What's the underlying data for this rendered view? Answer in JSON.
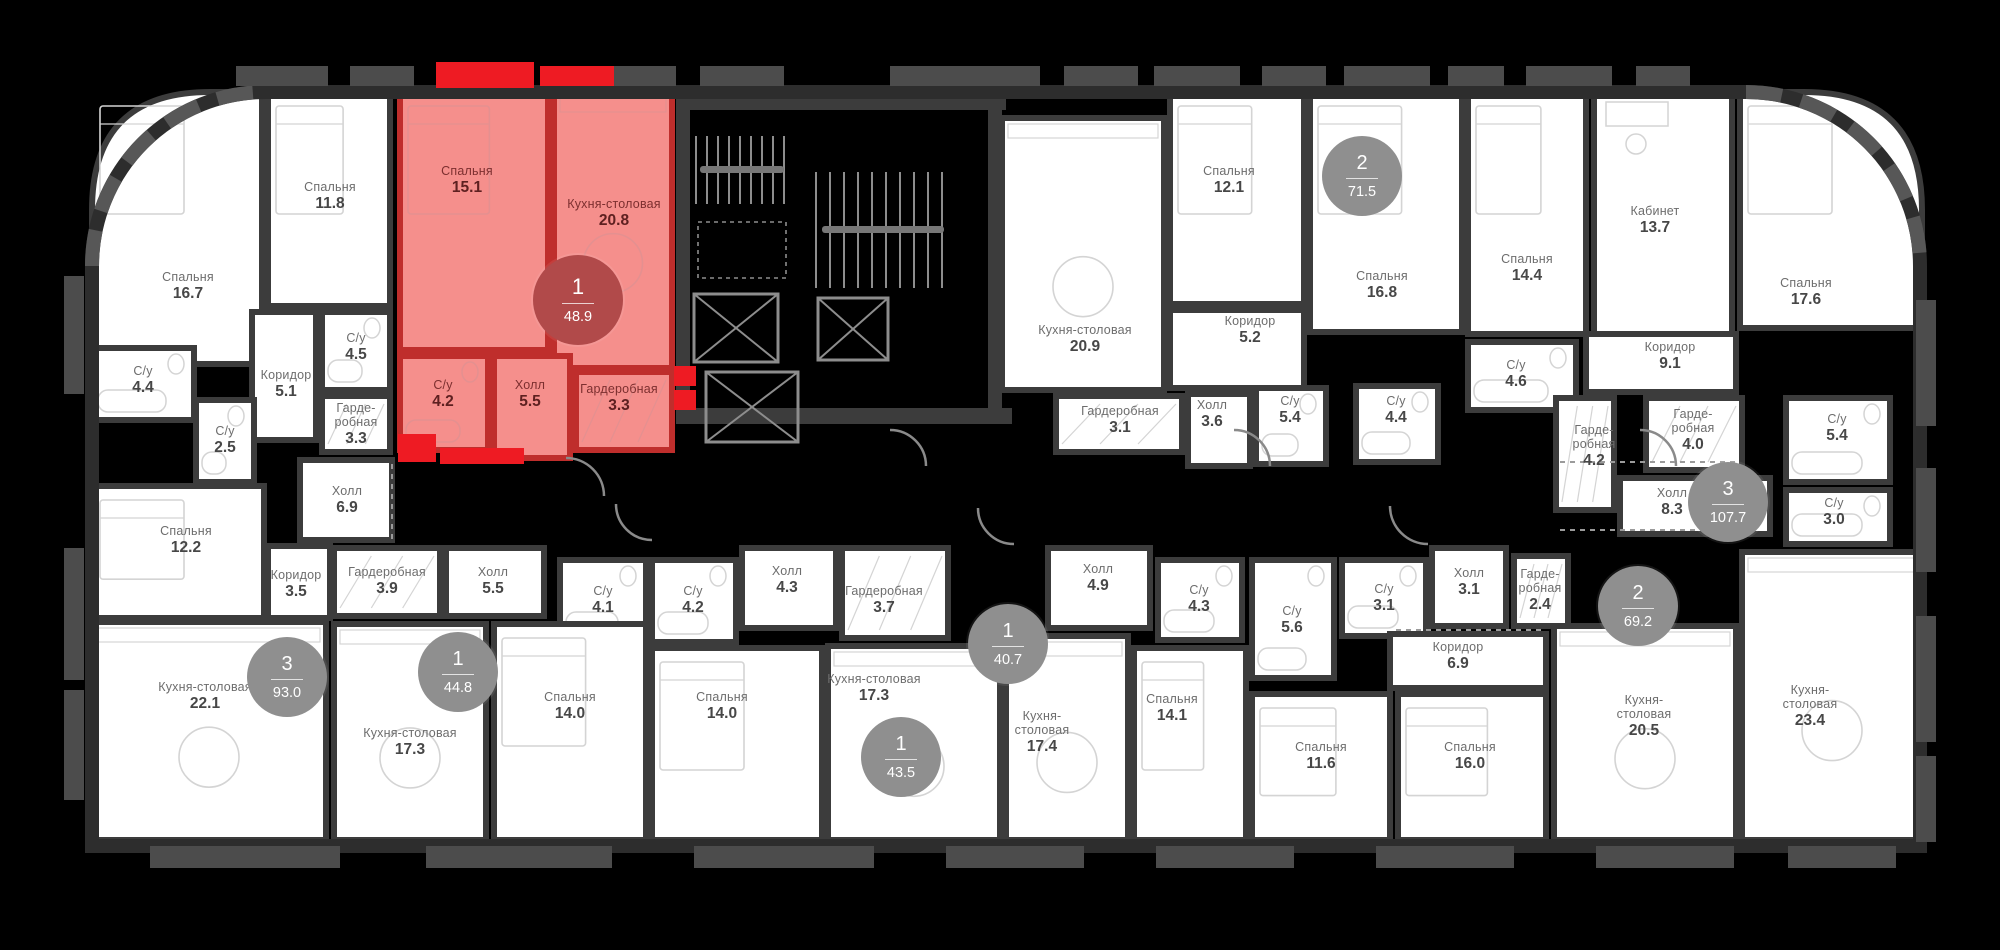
{
  "colors": {
    "background": "#000000",
    "room_fill": "#ffffff",
    "wall": "#3c3c3c",
    "outer_wall": "#2d2d2d",
    "outer_trim": "#575757",
    "tab": "#4c4c4c",
    "core": "#8d8d8d",
    "door_arc": "#8a8a8a",
    "dashed_line": "#9b9b9b",
    "highlight_fill": "#f58f8c",
    "highlight_wall": "#bf2e2c",
    "highlight_accent": "#ee1b23",
    "badge": "#8f8f8f",
    "badge_highlight": "#b14a4a",
    "furniture": "#d4d4d4",
    "furniture_highlight": "#e49090"
  },
  "apartments": [
    {
      "id": "apt-93-0",
      "rooms_count": "3",
      "area": "93.0",
      "highlighted": false,
      "badge": {
        "x": 287,
        "y": 677
      },
      "rooms": [
        {
          "name": "Спальня",
          "area": "16.7",
          "x": 92,
          "y": 92,
          "w": 170,
          "h": 272,
          "corner": "tl",
          "lx": 188,
          "ly": 286
        },
        {
          "name": "Спальня",
          "area": "11.8",
          "x": 268,
          "y": 92,
          "w": 122,
          "h": 214,
          "lx": 330,
          "ly": 196
        },
        {
          "name": "С/у",
          "area": "4.4",
          "x": 92,
          "y": 348,
          "w": 102,
          "h": 72,
          "lx": 143,
          "ly": 380
        },
        {
          "name": "С/у",
          "area": "4.5",
          "x": 322,
          "y": 312,
          "w": 68,
          "h": 78,
          "lx": 356,
          "ly": 347
        },
        {
          "name": "Коридор",
          "area": "5.1",
          "x": 252,
          "y": 312,
          "w": 64,
          "h": 128,
          "lx": 286,
          "ly": 384
        },
        {
          "name": "С/у",
          "area": "2.5",
          "x": 196,
          "y": 400,
          "w": 58,
          "h": 82,
          "lx": 225,
          "ly": 440
        },
        {
          "name": "Гарде-\nробная",
          "area": "3.3",
          "x": 322,
          "y": 396,
          "w": 68,
          "h": 56,
          "lx": 356,
          "ly": 424
        },
        {
          "name": "Холл",
          "area": "6.9",
          "x": 300,
          "y": 460,
          "w": 92,
          "h": 80,
          "lx": 347,
          "ly": 500
        },
        {
          "name": "Спальня",
          "area": "12.2",
          "x": 92,
          "y": 486,
          "w": 172,
          "h": 132,
          "lx": 186,
          "ly": 540
        },
        {
          "name": "Коридор",
          "area": "3.5",
          "x": 268,
          "y": 546,
          "w": 62,
          "h": 72,
          "lx": 296,
          "ly": 584
        },
        {
          "name": "Кухня-столовая",
          "area": "22.1",
          "x": 92,
          "y": 622,
          "w": 234,
          "h": 218,
          "lx": 205,
          "ly": 696
        }
      ]
    },
    {
      "id": "apt-48-9",
      "rooms_count": "1",
      "area": "48.9",
      "highlighted": true,
      "badge": {
        "x": 578,
        "y": 300
      },
      "rooms": [
        {
          "name": "Спальня",
          "area": "15.1",
          "x": 400,
          "y": 92,
          "w": 148,
          "h": 258,
          "lx": 467,
          "ly": 180
        },
        {
          "name": "Кухня-столовая",
          "area": "20.8",
          "x": 554,
          "y": 92,
          "w": 118,
          "h": 276,
          "lx": 614,
          "ly": 213
        },
        {
          "name": "С/у",
          "area": "4.2",
          "x": 400,
          "y": 356,
          "w": 88,
          "h": 94,
          "lx": 443,
          "ly": 394
        },
        {
          "name": "Холл",
          "area": "5.5",
          "x": 494,
          "y": 356,
          "w": 76,
          "h": 102,
          "lx": 530,
          "ly": 394
        },
        {
          "name": "Гардеробная",
          "area": "3.3",
          "x": 576,
          "y": 372,
          "w": 96,
          "h": 78,
          "lx": 619,
          "ly": 398
        }
      ]
    },
    {
      "id": "apt-44-8",
      "rooms_count": "1",
      "area": "44.8",
      "highlighted": false,
      "badge": {
        "x": 458,
        "y": 672
      },
      "rooms": [
        {
          "name": "Гардеробная",
          "area": "3.9",
          "x": 334,
          "y": 548,
          "w": 106,
          "h": 68,
          "lx": 387,
          "ly": 581
        },
        {
          "name": "Холл",
          "area": "5.5",
          "x": 446,
          "y": 548,
          "w": 98,
          "h": 68,
          "lx": 493,
          "ly": 581
        },
        {
          "name": "С/у",
          "area": "4.1",
          "x": 560,
          "y": 560,
          "w": 86,
          "h": 82,
          "lx": 603,
          "ly": 600
        },
        {
          "name": "Кухня-столовая",
          "area": "17.3",
          "x": 334,
          "y": 624,
          "w": 152,
          "h": 216,
          "lx": 410,
          "ly": 742
        },
        {
          "name": "Спальня",
          "area": "14.0",
          "x": 494,
          "y": 624,
          "w": 152,
          "h": 216,
          "lx": 570,
          "ly": 706
        }
      ]
    },
    {
      "id": "apt-43-5",
      "rooms_count": "1",
      "area": "43.5",
      "highlighted": false,
      "badge": {
        "x": 901,
        "y": 757
      },
      "rooms": [
        {
          "name": "С/у",
          "area": "4.2",
          "x": 652,
          "y": 560,
          "w": 84,
          "h": 82,
          "lx": 693,
          "ly": 600
        },
        {
          "name": "Холл",
          "area": "4.3",
          "x": 742,
          "y": 548,
          "w": 94,
          "h": 80,
          "lx": 787,
          "ly": 580
        },
        {
          "name": "Гардеробная",
          "area": "3.7",
          "x": 842,
          "y": 548,
          "w": 106,
          "h": 90,
          "lx": 884,
          "ly": 600
        },
        {
          "name": "Спальня",
          "area": "14.0",
          "x": 652,
          "y": 648,
          "w": 170,
          "h": 192,
          "lx": 722,
          "ly": 706
        },
        {
          "name": "Кухня-столовая",
          "area": "17.3",
          "x": 828,
          "y": 646,
          "w": 172,
          "h": 194,
          "lx": 874,
          "ly": 688
        }
      ]
    },
    {
      "id": "apt-40-7",
      "rooms_count": "1",
      "area": "40.7",
      "highlighted": false,
      "badge": {
        "x": 1008,
        "y": 644
      },
      "rooms": [
        {
          "name": "Холл",
          "area": "4.9",
          "x": 1048,
          "y": 548,
          "w": 102,
          "h": 80,
          "lx": 1098,
          "ly": 578
        },
        {
          "name": "С/у",
          "area": "4.3",
          "x": 1158,
          "y": 560,
          "w": 84,
          "h": 80,
          "lx": 1199,
          "ly": 599
        },
        {
          "name": "Кухня-\nстоловая",
          "area": "17.4",
          "x": 1006,
          "y": 636,
          "w": 122,
          "h": 204,
          "lx": 1042,
          "ly": 732
        },
        {
          "name": "Спальня",
          "area": "14.1",
          "x": 1134,
          "y": 648,
          "w": 112,
          "h": 192,
          "lx": 1172,
          "ly": 708
        }
      ]
    },
    {
      "id": "apt-71-5",
      "rooms_count": "2",
      "area": "71.5",
      "highlighted": false,
      "badge": {
        "x": 1362,
        "y": 176
      },
      "rooms": [
        {
          "name": "Кухня-столовая",
          "area": "20.9",
          "x": 1002,
          "y": 118,
          "w": 162,
          "h": 272,
          "lx": 1085,
          "ly": 339
        },
        {
          "name": "Спальня",
          "area": "12.1",
          "x": 1170,
          "y": 92,
          "w": 134,
          "h": 212,
          "lx": 1229,
          "ly": 180
        },
        {
          "name": "Спальня",
          "area": "16.8",
          "x": 1310,
          "y": 92,
          "w": 152,
          "h": 240,
          "lx": 1382,
          "ly": 285
        },
        {
          "name": "Коридор",
          "area": "5.2",
          "x": 1170,
          "y": 310,
          "w": 134,
          "h": 78,
          "lx": 1250,
          "ly": 330
        },
        {
          "name": "Гардеробная",
          "area": "3.1",
          "x": 1056,
          "y": 396,
          "w": 126,
          "h": 56,
          "lx": 1120,
          "ly": 420
        },
        {
          "name": "Холл",
          "area": "3.6",
          "x": 1188,
          "y": 394,
          "w": 62,
          "h": 72,
          "lx": 1212,
          "ly": 414
        },
        {
          "name": "С/у",
          "area": "5.4",
          "x": 1256,
          "y": 388,
          "w": 70,
          "h": 76,
          "lx": 1290,
          "ly": 410
        },
        {
          "name": "С/у",
          "area": "4.4",
          "x": 1356,
          "y": 386,
          "w": 82,
          "h": 76,
          "lx": 1396,
          "ly": 410
        }
      ]
    },
    {
      "id": "apt-69-2",
      "rooms_count": "2",
      "area": "69.2",
      "highlighted": false,
      "badge": {
        "x": 1638,
        "y": 606
      },
      "rooms": [
        {
          "name": "С/у",
          "area": "5.6",
          "x": 1252,
          "y": 560,
          "w": 82,
          "h": 118,
          "lx": 1292,
          "ly": 620
        },
        {
          "name": "С/у",
          "area": "3.1",
          "x": 1342,
          "y": 560,
          "w": 84,
          "h": 76,
          "lx": 1384,
          "ly": 598
        },
        {
          "name": "Холл",
          "area": "3.1",
          "x": 1432,
          "y": 548,
          "w": 74,
          "h": 78,
          "lx": 1469,
          "ly": 582
        },
        {
          "name": "Гарде-\nробная",
          "area": "2.4",
          "x": 1514,
          "y": 556,
          "w": 54,
          "h": 70,
          "lx": 1540,
          "ly": 590
        },
        {
          "name": "Коридор",
          "area": "6.9",
          "x": 1390,
          "y": 634,
          "w": 156,
          "h": 54,
          "lx": 1458,
          "ly": 656
        },
        {
          "name": "Спальня",
          "area": "11.6",
          "x": 1252,
          "y": 694,
          "w": 138,
          "h": 146,
          "lx": 1321,
          "ly": 756
        },
        {
          "name": "Спальня",
          "area": "16.0",
          "x": 1398,
          "y": 694,
          "w": 148,
          "h": 146,
          "lx": 1470,
          "ly": 756
        },
        {
          "name": "Кухня-\nстоловая",
          "area": "20.5",
          "x": 1554,
          "y": 626,
          "w": 182,
          "h": 214,
          "lx": 1644,
          "ly": 716
        }
      ]
    },
    {
      "id": "apt-107-7",
      "rooms_count": "3",
      "area": "107.7",
      "highlighted": false,
      "badge": {
        "x": 1728,
        "y": 502
      },
      "rooms": [
        {
          "name": "Спальня",
          "area": "14.4",
          "x": 1468,
          "y": 92,
          "w": 118,
          "h": 242,
          "lx": 1527,
          "ly": 268
        },
        {
          "name": "С/у",
          "area": "4.6",
          "x": 1468,
          "y": 342,
          "w": 108,
          "h": 68,
          "lx": 1516,
          "ly": 374
        },
        {
          "name": "Кабинет",
          "area": "13.7",
          "x": 1594,
          "y": 92,
          "w": 138,
          "h": 262,
          "lx": 1655,
          "ly": 220
        },
        {
          "name": "Спальня",
          "area": "17.6",
          "x": 1740,
          "y": 92,
          "w": 182,
          "h": 236,
          "corner": "tr",
          "lx": 1806,
          "ly": 292
        },
        {
          "name": "Коридор",
          "area": "9.1",
          "x": 1586,
          "y": 334,
          "w": 150,
          "h": 58,
          "lx": 1670,
          "ly": 356
        },
        {
          "name": "Гарде-\nробная",
          "area": "4.2",
          "x": 1556,
          "y": 398,
          "w": 58,
          "h": 112,
          "lx": 1594,
          "ly": 446
        },
        {
          "name": "Гарде-\nробная",
          "area": "4.0",
          "x": 1646,
          "y": 398,
          "w": 96,
          "h": 72,
          "lx": 1693,
          "ly": 430
        },
        {
          "name": "С/у",
          "area": "5.4",
          "x": 1786,
          "y": 398,
          "w": 104,
          "h": 84,
          "lx": 1837,
          "ly": 428
        },
        {
          "name": "Холл",
          "area": "8.3",
          "x": 1620,
          "y": 478,
          "w": 150,
          "h": 56,
          "lx": 1672,
          "ly": 502
        },
        {
          "name": "С/у",
          "area": "3.0",
          "x": 1786,
          "y": 490,
          "w": 104,
          "h": 54,
          "lx": 1834,
          "ly": 512
        },
        {
          "name": "Кухня-\nстоловая",
          "area": "23.4",
          "x": 1742,
          "y": 552,
          "w": 180,
          "h": 288,
          "lx": 1810,
          "ly": 706
        }
      ]
    }
  ]
}
